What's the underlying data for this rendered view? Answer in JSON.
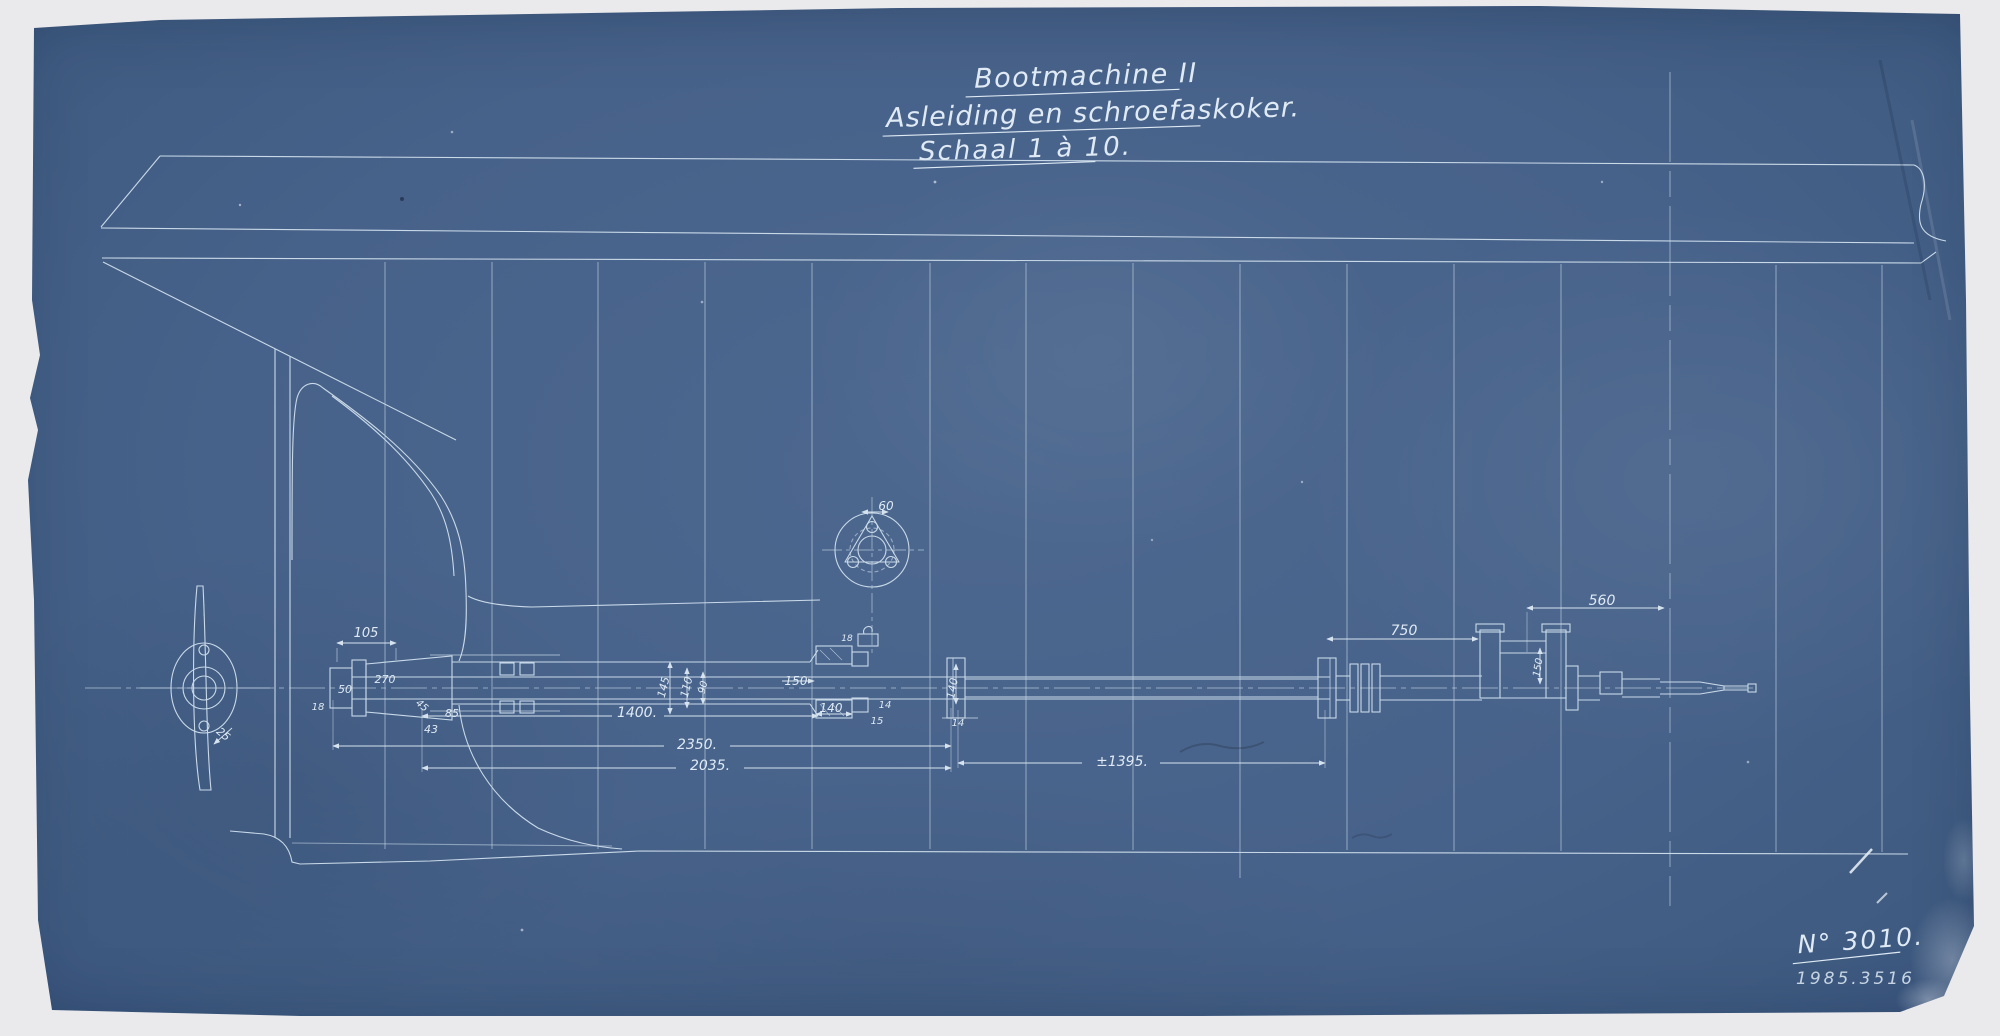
{
  "title_block": {
    "line1": "Bootmachine II",
    "line2": "Asleiding en schroefaskoker.",
    "line3": "Schaal 1 à 10."
  },
  "drawing_number": "N° 3010.",
  "accession_stamp": "1985.3516",
  "dims": {
    "d105": "105",
    "d50": "50",
    "d270": "270",
    "d18a": "18",
    "d45": "45",
    "d43": "43",
    "d85": "85",
    "d25": "25",
    "d145": "145",
    "d110": "110",
    "d90": "90",
    "d1400": "1400.",
    "d2350": "2350.",
    "d2035": "2035.",
    "d150a": "150",
    "d140a": "140",
    "d140b": "140",
    "d14a": "14",
    "d14b": "14",
    "d15": "15",
    "d18b": "18",
    "d1395": "±1395.",
    "d750": "750",
    "d560": "560",
    "d150b": "150",
    "d60": "60"
  },
  "colors": {
    "paper": "#47628a",
    "line": "#c9d9e8",
    "background": "#eae9eb"
  }
}
